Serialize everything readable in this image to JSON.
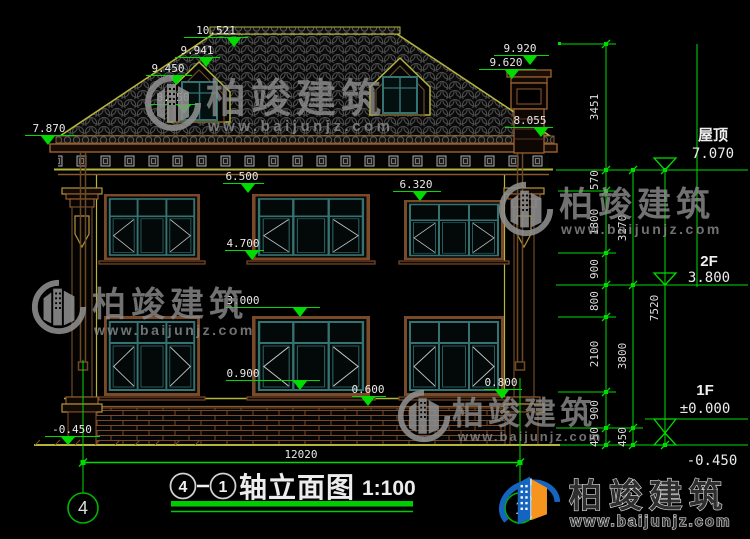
{
  "drawing": {
    "type": "building-elevation",
    "scale": "1:100",
    "title": {
      "axis_from": "4",
      "separator": "—",
      "axis_to": "1",
      "name": "轴立面图",
      "scale": "1:100"
    },
    "axis_bubbles": {
      "left": "4",
      "right": "1"
    }
  },
  "dimensions": {
    "ridge": "10.521",
    "dormer_ridge": "9.941",
    "dormer_eave": "9.450",
    "dormer_sill": "8.550",
    "left_eave": "7.870",
    "chimney_top": "9.920",
    "chimney_cap": "9.620",
    "right_eave": "8.055",
    "win2f_top": "6.500",
    "win2f_top_right": "6.320",
    "win2f_sill": "4.700",
    "win1f_top": "3.000",
    "win1f_sill": "0.900",
    "plinth": "0.600",
    "pier_base": "0.800",
    "ground_left": "-0.450",
    "total_width": "12020"
  },
  "right_dimension_chains": {
    "chain_inner": [
      "3451",
      "570",
      "1800",
      "900",
      "800",
      "2100",
      "900",
      "450"
    ],
    "chain_mid": [
      "3270",
      "3800",
      "450"
    ],
    "chain_outer": [
      "7520"
    ]
  },
  "elevation_markers": [
    {
      "label": "屋顶",
      "value": "7.070"
    },
    {
      "label": "2F",
      "value": "3.800"
    },
    {
      "label": "1F",
      "value": "±0.000"
    },
    {
      "label": "",
      "value": "-0.450"
    }
  ],
  "watermarks": {
    "brand": "柏竣建筑",
    "url": "www.baijunjz.com"
  },
  "colors": {
    "dimension_green": "#00dc00",
    "outline_olive": "#b5b53c",
    "trim_brown": "#8a5a2b",
    "window_teal": "#357272",
    "text_white": "#e8e8e8",
    "watermark_gray": "#8f8f8f",
    "logo_blue": "#1565c0",
    "logo_orange": "#f7941d"
  }
}
